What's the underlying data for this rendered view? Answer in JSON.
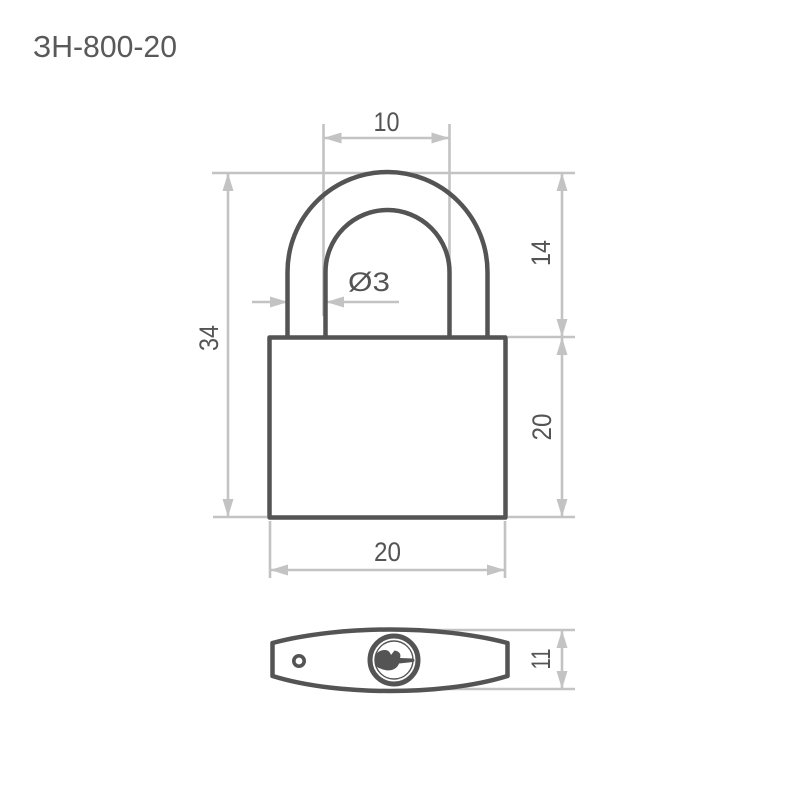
{
  "title": "ЗН-800-20",
  "colors": {
    "outline": "#545454",
    "dimension_lines": "#c3c3c3",
    "text": "#545454",
    "background": "#ffffff"
  },
  "front_view": {
    "dimensions": {
      "shackle_inner_width": "10",
      "shackle_diameter": "Ø3",
      "total_height": "34",
      "shackle_height": "14",
      "body_height": "20",
      "body_width": "20"
    }
  },
  "bottom_view": {
    "dimensions": {
      "body_thickness": "11"
    }
  }
}
